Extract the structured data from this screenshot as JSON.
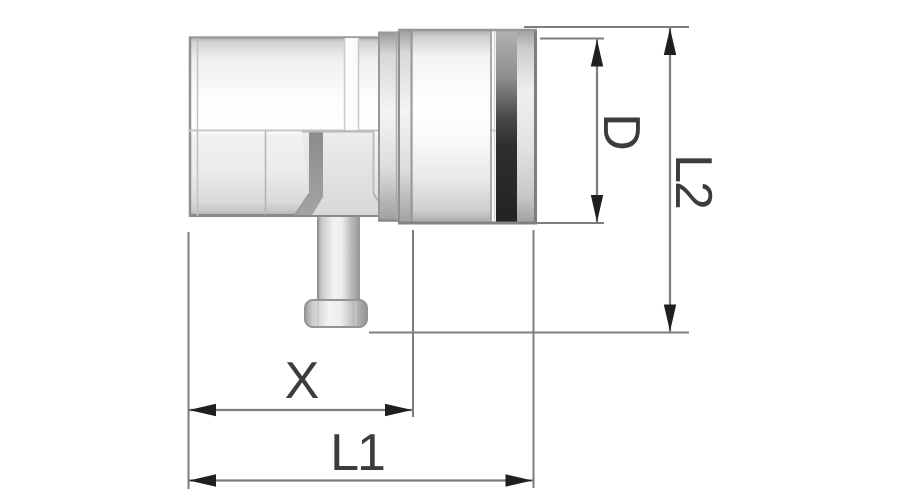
{
  "drawing": {
    "labels": {
      "diameter": "D",
      "length_total": "L2",
      "branch_offset": "X",
      "length_overall": "L1"
    },
    "colors": {
      "background": "#ffffff",
      "outline": "#8f8f8f",
      "dimension_line": "#7d7d7d",
      "extension_line": "#7d7d7d",
      "arrow": "#1f1f1f",
      "label_text": "#3c3c3c",
      "gasket_dark": "#2e2e2e",
      "body_light": "#f7f7f7",
      "body_shade": "#c9c9c9"
    }
  }
}
